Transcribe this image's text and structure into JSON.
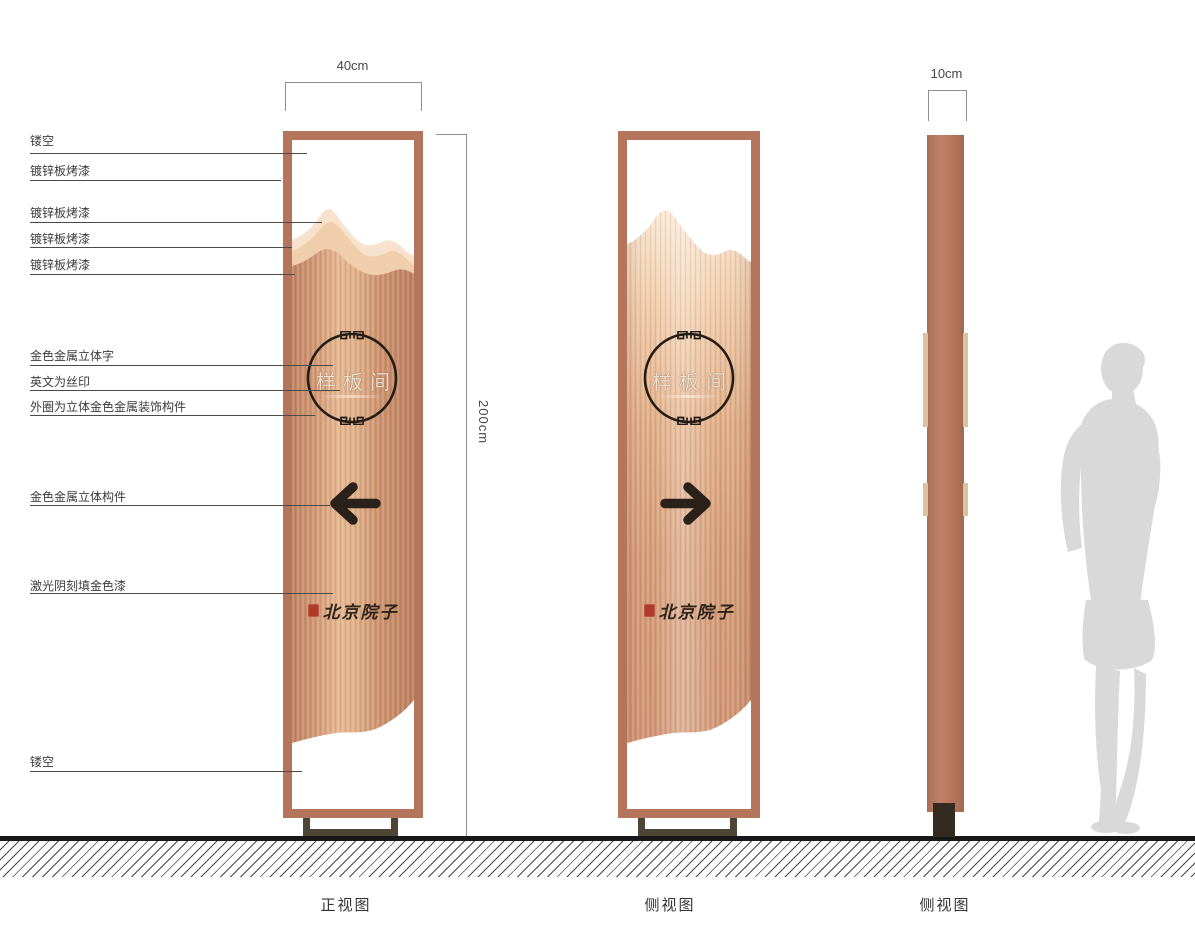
{
  "views": {
    "front_label": "正视图",
    "side_label_1": "侧视图",
    "side_label_2": "侧视图"
  },
  "dimensions": {
    "front_width": "40cm",
    "height": "200cm",
    "side_width": "10cm"
  },
  "callouts": [
    {
      "label": "镂空"
    },
    {
      "label": "镀锌板烤漆"
    },
    {
      "label": "镀锌板烤漆"
    },
    {
      "label": "镀锌板烤漆"
    },
    {
      "label": "镀锌板烤漆"
    },
    {
      "label": "金色金属立体字"
    },
    {
      "label": "英文为丝印"
    },
    {
      "label": "外圈为立体金色金属装饰构件"
    },
    {
      "label": "金色金属立体构件"
    },
    {
      "label": "激光阴刻填金色漆"
    },
    {
      "label": "镂空"
    }
  ],
  "signage": {
    "panel_text": "样板间",
    "brand_text": "北京院子"
  },
  "colors": {
    "frame_copper": "#b5745c",
    "body_copper": "#d49a76",
    "mountain_light": "#f7e3cd",
    "mountain_mid": "#f0cdab",
    "accent_dark": "#241c16",
    "seal_red": "#b23a28",
    "base_stand": "#4d4636",
    "side_protrusion": "#d9c29d",
    "ground_black": "#181818",
    "silhouette_gray": "#d9d9d9"
  }
}
